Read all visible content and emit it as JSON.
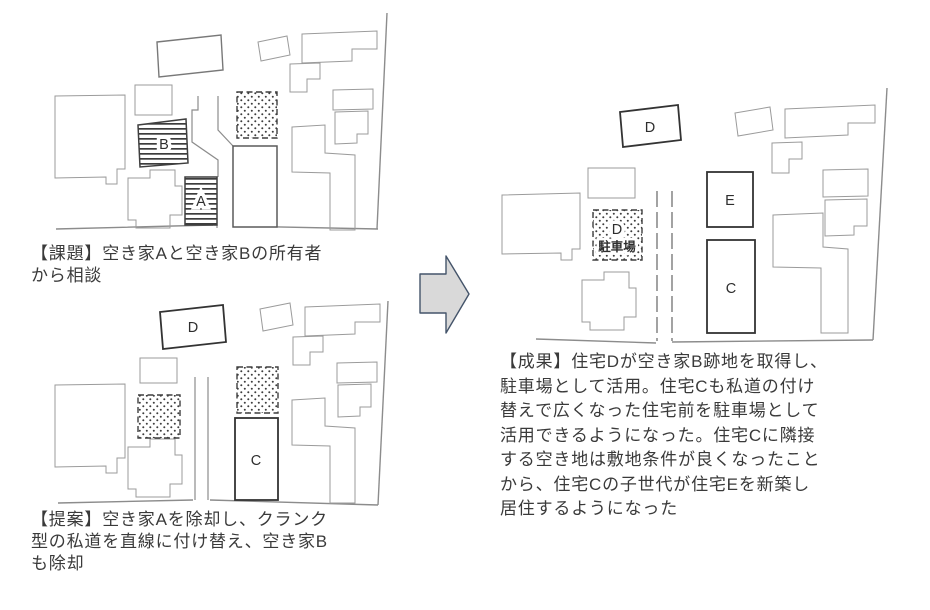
{
  "figure": {
    "type": "before-after-town-block-diagram",
    "arrow_direction": "right"
  },
  "panels": {
    "before": {
      "caption": "【課題】空き家Aと空き家Bの所有者\nから相談",
      "labels": {
        "a": "A",
        "b": "B"
      }
    },
    "proposal": {
      "caption": "【提案】空き家Aを除却し、クランク\n型の私道を直線に付け替え、空き家B\nも除却",
      "labels": {
        "d": "D",
        "c": "C"
      }
    },
    "result": {
      "caption": "【成果】住宅Dが空き家B跡地を取得し、\n駐車場として活用。住宅Cも私道の付け\n替えで広くなった住宅前を駐車場として\n活用できるようになった。住宅Cに隣接\nする空き地は敷地条件が良くなったこと\nから、住宅Cの子世代が住宅Eを新築し\n居住するようになった",
      "labels": {
        "d": "D",
        "parking_owner": "D",
        "parking": "駐車場",
        "e": "E",
        "c": "C"
      }
    }
  },
  "colors": {
    "text": "#3a3a3a",
    "building_outline_bold": "#333333",
    "building_outline_light": "#9b9b9b",
    "hatch": "#3d3d3d",
    "arrow_fill": "#d9d9d9",
    "arrow_stroke": "#44546a"
  }
}
